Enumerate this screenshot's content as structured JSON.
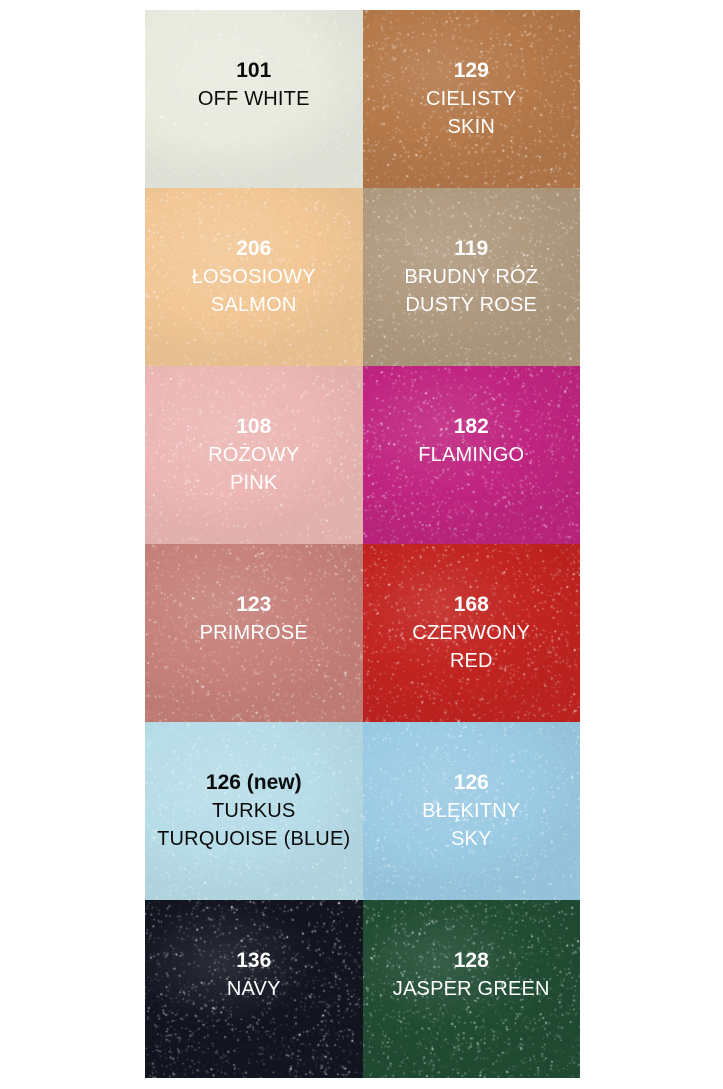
{
  "page": {
    "background": "#ffffff",
    "description_title": "Glitter tights color chart"
  },
  "grid": {
    "columns": 2,
    "rows": 6
  },
  "swatches": [
    {
      "number": "101",
      "name_lines": [
        "OFF WHITE"
      ],
      "color": "#e9ebdf",
      "text_color": "#0b0b0b"
    },
    {
      "number": "129",
      "name_lines": [
        "CIELISTY",
        "SKIN"
      ],
      "color": "#b5794a",
      "text_color": "#ffffff"
    },
    {
      "number": "206",
      "name_lines": [
        "ŁOSOSIOWY",
        "SALMON"
      ],
      "color": "#f2c795",
      "text_color": "#ffffff"
    },
    {
      "number": "119",
      "name_lines": [
        "BRUDNY RÓŻ",
        "DUSTY ROSE"
      ],
      "color": "#b09a7f",
      "text_color": "#ffffff"
    },
    {
      "number": "108",
      "name_lines": [
        "RÓŻOWY",
        "PINK"
      ],
      "color": "#ecb7b4",
      "text_color": "#ffffff"
    },
    {
      "number": "182",
      "name_lines": [
        "FLAMINGO"
      ],
      "color": "#c02581",
      "text_color": "#ffffff"
    },
    {
      "number": "123",
      "name_lines": [
        "PRIMROSE"
      ],
      "color": "#c6817a",
      "text_color": "#ffffff"
    },
    {
      "number": "168",
      "name_lines": [
        "CZERWONY",
        "RED"
      ],
      "color": "#c22420",
      "text_color": "#ffffff"
    },
    {
      "number": "126 (new)",
      "name_lines": [
        "TURKUS",
        "TURQUOISE (BLUE)"
      ],
      "color": "#b7dde9",
      "text_color": "#0b0b0b"
    },
    {
      "number": "126",
      "name_lines": [
        "BŁĘKITNY",
        "SKY"
      ],
      "color": "#9bcbe4",
      "text_color": "#ffffff"
    },
    {
      "number": "136",
      "name_lines": [
        "NAVY"
      ],
      "color": "#131521",
      "text_color": "#ffffff"
    },
    {
      "number": "128",
      "name_lines": [
        "JASPER GREEN"
      ],
      "color": "#214d33",
      "text_color": "#ffffff"
    }
  ]
}
